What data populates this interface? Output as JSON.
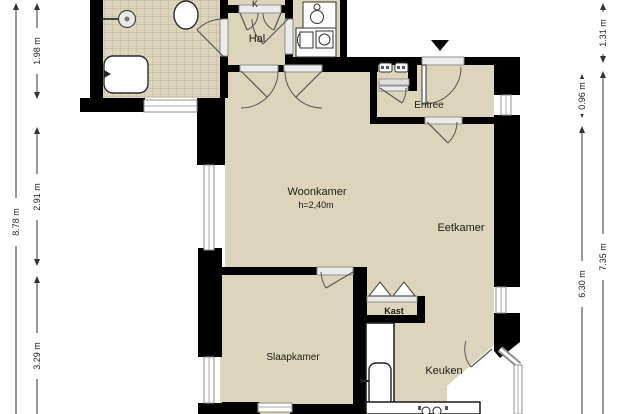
{
  "floorplan": {
    "rooms": {
      "hal": "Hal",
      "entree": "Entree",
      "woonkamer": "Woonkamer",
      "woonkamer_height": "h=2,40m",
      "eetkamer": "Eetkamer",
      "kast": "Kast",
      "slaapkamer": "Slaapkamer",
      "keuken": "Keuken",
      "closet_label_clipped": "K"
    },
    "dimensions": {
      "left_outer": "8.78 m",
      "left_inner": [
        "1.98 m",
        "2.91 m",
        "3.29 m"
      ],
      "right_inner": [
        "0.96 m",
        "6.30 m"
      ],
      "right_outer": [
        "1.31 m",
        "7.35 m"
      ]
    },
    "colors": {
      "floor": "#dcd5bc",
      "wall": "#000000",
      "tile_grid": "#b3ab8f",
      "window_frame": "#8f8f8f",
      "dimension_line": "#333333",
      "text": "#1a1a1a",
      "background": "#ffffff"
    },
    "icons": [
      "toilet-icon",
      "shower-icon",
      "bathtub-icon",
      "boiler-icon",
      "washing-machine-icon",
      "dryer-icon",
      "meter-icon",
      "sink-icon",
      "stove-icon",
      "entrance-marker-icon"
    ]
  }
}
